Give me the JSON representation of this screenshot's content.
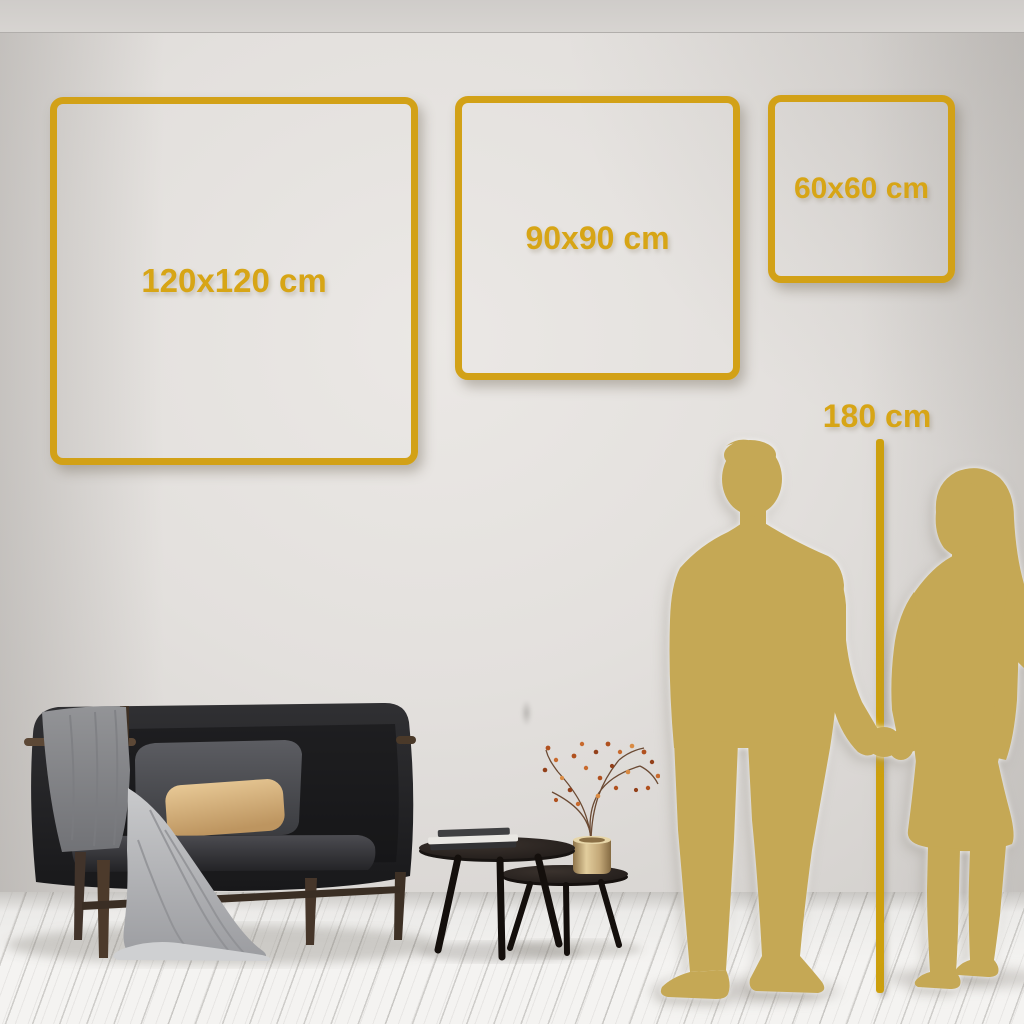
{
  "scene": {
    "description": "Wall art size guide in living room",
    "accent_color": "#D2A117",
    "silhouette_color": "#C5A855",
    "wall_color": "#E3E0DD",
    "floor_color": "#F2F1EF"
  },
  "size_frames": [
    {
      "label": "120x120 cm",
      "width_cm": 120,
      "height_cm": 120
    },
    {
      "label": "90x90 cm",
      "width_cm": 90,
      "height_cm": 90
    },
    {
      "label": "60x60 cm",
      "width_cm": 60,
      "height_cm": 60
    }
  ],
  "height_reference": {
    "label": "180 cm",
    "value_cm": 180
  },
  "objects": {
    "couple": "couple-silhouette-holding-hands",
    "sofa": "dark-sofa-with-blanket-and-pillows",
    "tables": "nesting-coffee-tables-with-books",
    "vase": "brass-vase-with-dried-branch"
  }
}
